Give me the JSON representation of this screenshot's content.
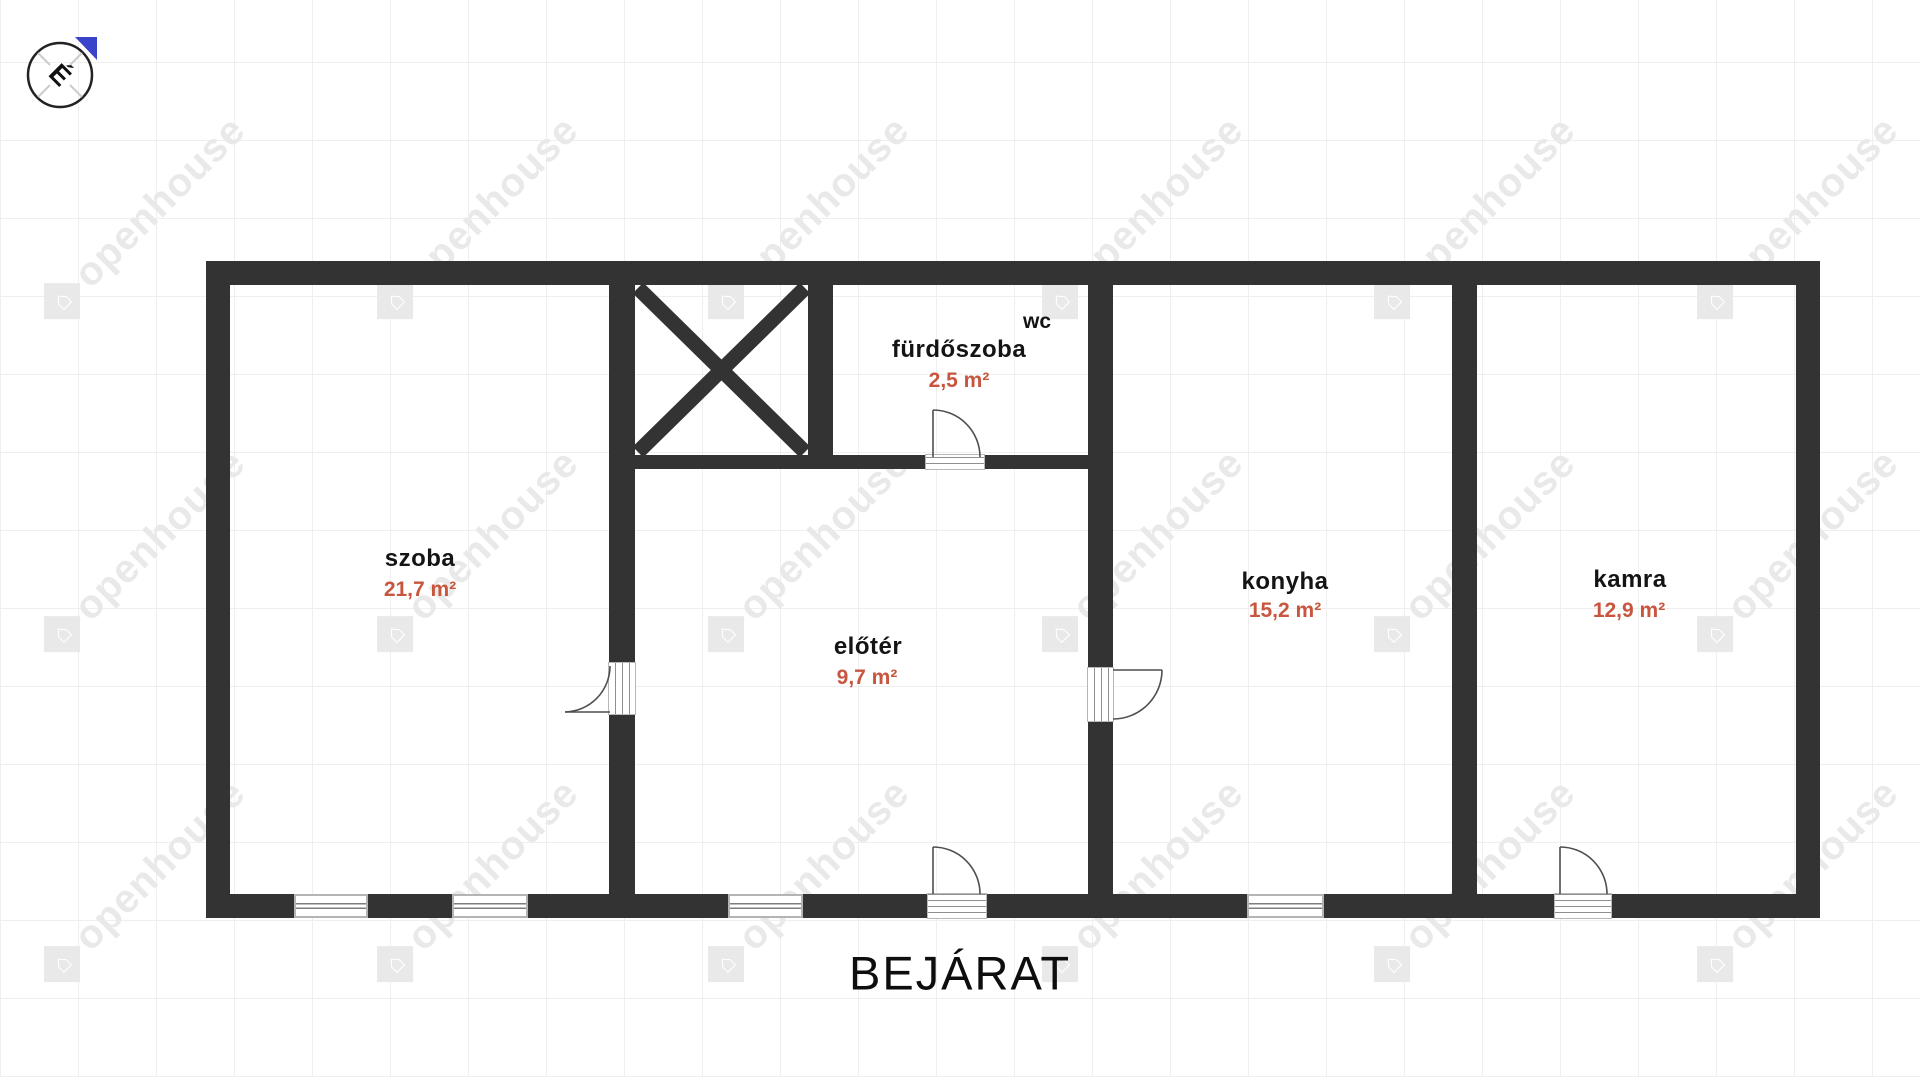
{
  "plan": {
    "compass": {
      "label": "É"
    },
    "entrance_label": "BEJÁRAT",
    "watermark": {
      "text": "openhouse"
    },
    "rooms": [
      {
        "id": "szoba",
        "name": "szoba",
        "area": "21,7 m²"
      },
      {
        "id": "furdoszoba",
        "name": "fürdőszoba",
        "area": "2,5 m²",
        "sub_label": "wc"
      },
      {
        "id": "eloter",
        "name": "előtér",
        "area": "9,7 m²"
      },
      {
        "id": "konyha",
        "name": "konyha",
        "area": "15,2 m²"
      },
      {
        "id": "kamra",
        "name": "kamra",
        "area": "12,9 m²"
      }
    ],
    "colors": {
      "wall": "#333333",
      "area_text": "#c8563e",
      "compass_north": "#3a44cb"
    }
  }
}
